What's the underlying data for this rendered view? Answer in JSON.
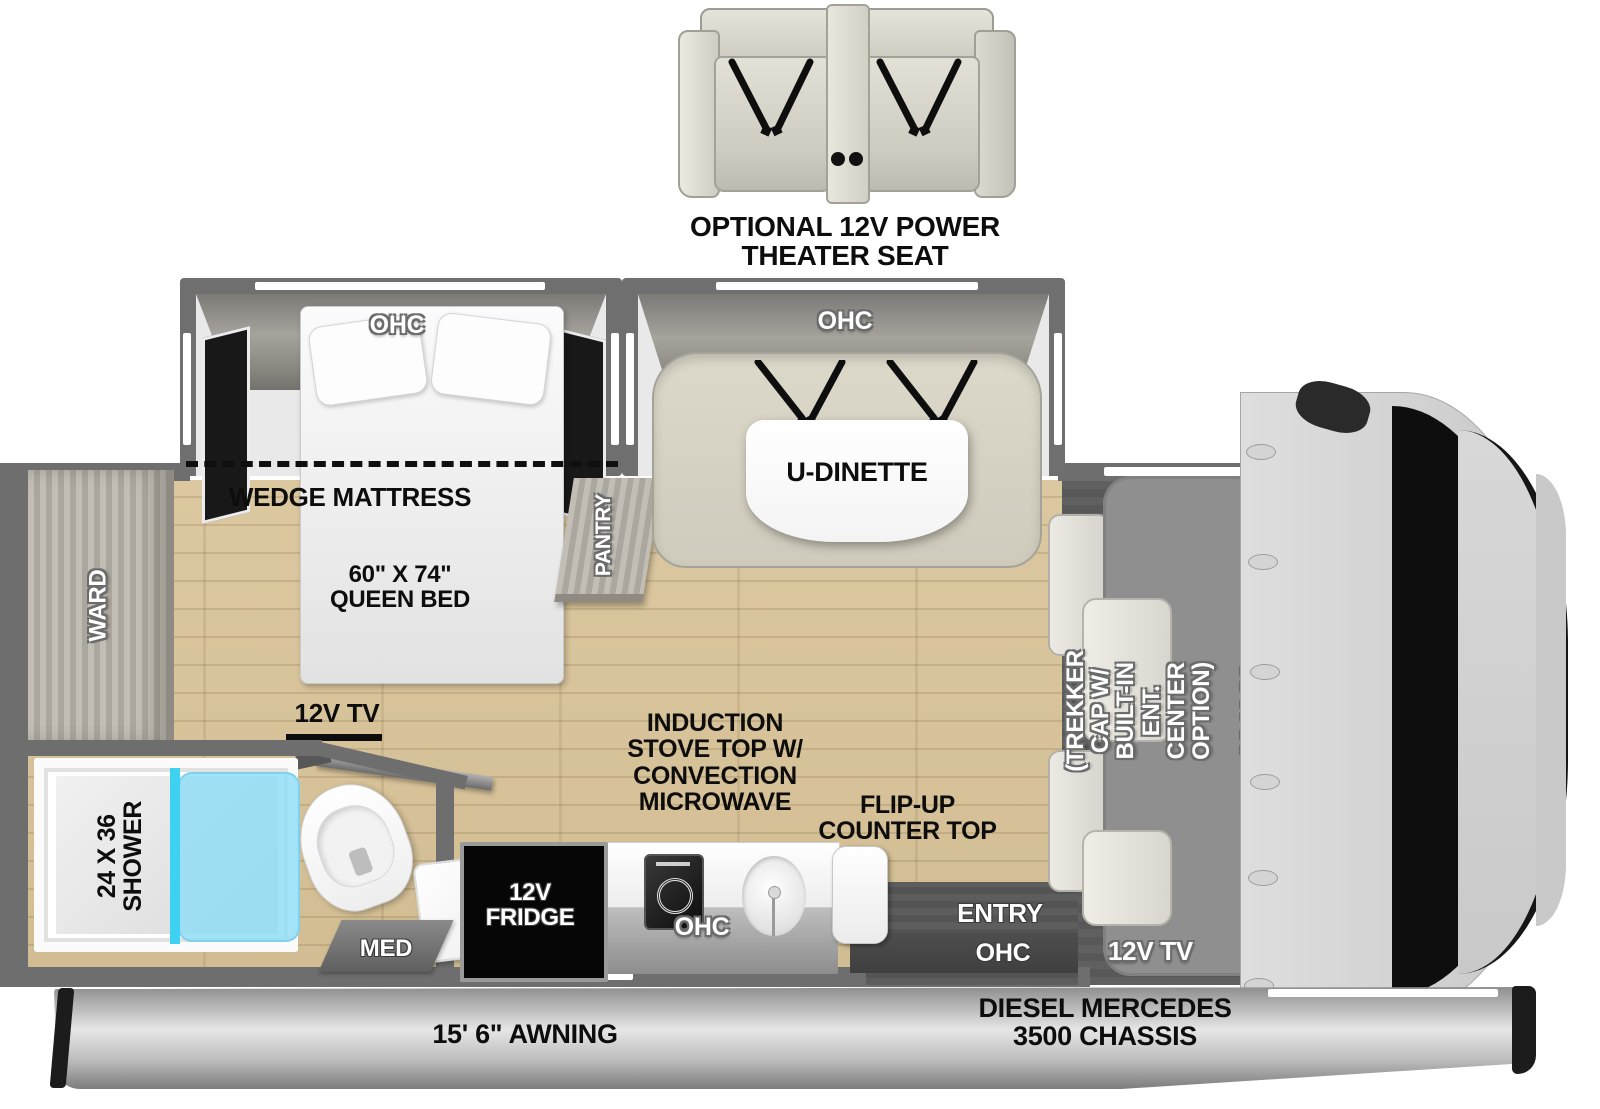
{
  "colors": {
    "wood_floor": "#d8c49c",
    "wall_gray": "#6e6e6e",
    "shower_glass": "#52d5f0",
    "bench_cream": "#d9d5c6",
    "bunk_gray": "#8f8f8f",
    "cab_gray": "#d7d7d7",
    "fridge_black": "#050505",
    "label_black": "#0d0d0d",
    "label_white": "#ffffff"
  },
  "optional_seat": {
    "label": "OPTIONAL 12V POWER\nTHEATER SEAT"
  },
  "bedroom": {
    "ohc": "OHC",
    "wedge_mattress": "WEDGE MATTRESS",
    "queen_bed": "60\" X 74\"\nQUEEN BED",
    "ward": "WARD",
    "pantry": "PANTRY",
    "tv": "12V TV"
  },
  "dinette": {
    "ohc": "OHC",
    "table": "U-DINETTE"
  },
  "bathroom": {
    "shower": "24 X 36\nSHOWER",
    "med": "MED"
  },
  "kitchen": {
    "fridge": "12V\nFRIDGE",
    "ohc": "OHC",
    "stove": "INDUCTION\nSTOVE TOP W/\nCONVECTION\nMICROWAVE",
    "flip_counter": "FLIP-UP\nCOUNTER TOP"
  },
  "entry": {
    "door": "ENTRY",
    "ohc": "OHC"
  },
  "bunk": {
    "option": "(TREKKER CAP W/ BUILT-IN\nENT. CENTER OPTION)",
    "size": "60 X 80 BUNK",
    "tv": "12V TV"
  },
  "exterior": {
    "awning": "15' 6\" AWNING",
    "chassis": "DIESEL MERCEDES\n3500 CHASSIS"
  }
}
